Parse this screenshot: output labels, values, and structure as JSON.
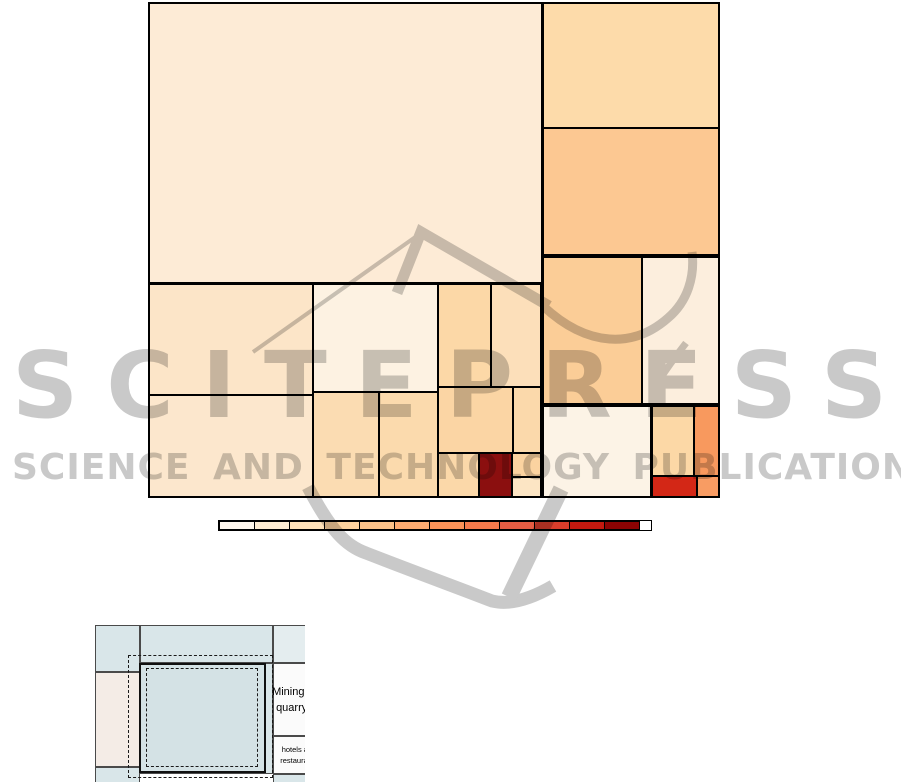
{
  "watermark": {
    "title": "SCITEPRESS",
    "subtitle": "SCIENCE AND TECHNOLOGY PUBLICATIONS",
    "color": "#c9c9c9"
  },
  "chart_data": [
    {
      "type": "treemap",
      "title": "",
      "description": "Unlabeled treemap of rectangles shaded by an OrRd (cream-to-dark-red) color scale",
      "bounds": {
        "x": 148,
        "y": 2,
        "w": 572,
        "h": 496
      },
      "cells": [
        {
          "x": 148,
          "y": 2,
          "w": 394,
          "h": 281,
          "c": "#fdebd6"
        },
        {
          "x": 542,
          "y": 2,
          "w": 178,
          "h": 126,
          "c": "#fddbaa"
        },
        {
          "x": 542,
          "y": 128,
          "w": 178,
          "h": 128,
          "c": "#fcc892"
        },
        {
          "x": 542,
          "y": 256,
          "w": 100,
          "h": 149,
          "c": "#fbcd97"
        },
        {
          "x": 642,
          "y": 256,
          "w": 78,
          "h": 149,
          "c": "#fceedd"
        },
        {
          "x": 542,
          "y": 405,
          "w": 109,
          "h": 93,
          "c": "#fcf3e6"
        },
        {
          "x": 651,
          "y": 405,
          "w": 43,
          "h": 71,
          "c": "#fcd8a6"
        },
        {
          "x": 694,
          "y": 405,
          "w": 26,
          "h": 71,
          "c": "#f8995e"
        },
        {
          "x": 651,
          "y": 476,
          "w": 46,
          "h": 22,
          "c": "#d32716"
        },
        {
          "x": 697,
          "y": 476,
          "w": 23,
          "h": 22,
          "c": "#f89c63"
        },
        {
          "x": 148,
          "y": 283,
          "w": 165,
          "h": 112,
          "c": "#fce5c8"
        },
        {
          "x": 148,
          "y": 395,
          "w": 165,
          "h": 103,
          "c": "#fce7cd"
        },
        {
          "x": 313,
          "y": 283,
          "w": 125,
          "h": 109,
          "c": "#fdf2e2"
        },
        {
          "x": 313,
          "y": 392,
          "w": 66,
          "h": 106,
          "c": "#fbdcb2"
        },
        {
          "x": 379,
          "y": 392,
          "w": 59,
          "h": 106,
          "c": "#fbdaad"
        },
        {
          "x": 438,
          "y": 283,
          "w": 53,
          "h": 104,
          "c": "#fcd8a7"
        },
        {
          "x": 491,
          "y": 283,
          "w": 51,
          "h": 104,
          "c": "#fcdfba"
        },
        {
          "x": 438,
          "y": 387,
          "w": 75,
          "h": 66,
          "c": "#fbd5a4"
        },
        {
          "x": 513,
          "y": 387,
          "w": 29,
          "h": 66,
          "c": "#fbd9ab"
        },
        {
          "x": 438,
          "y": 453,
          "w": 41,
          "h": 45,
          "c": "#fbd8a9"
        },
        {
          "x": 479,
          "y": 453,
          "w": 33,
          "h": 45,
          "c": "#8b0f0f"
        },
        {
          "x": 512,
          "y": 453,
          "w": 30,
          "h": 24,
          "c": "#fbd3a0"
        },
        {
          "x": 512,
          "y": 477,
          "w": 30,
          "h": 21,
          "c": "#fce5c4"
        }
      ],
      "group_outlines": [
        {
          "x": 148,
          "y": 2,
          "w": 572,
          "h": 496
        },
        {
          "x": 542,
          "y": 2,
          "w": 178,
          "h": 254
        },
        {
          "x": 148,
          "y": 283,
          "w": 394,
          "h": 215
        },
        {
          "x": 542,
          "y": 256,
          "w": 178,
          "h": 149
        },
        {
          "x": 542,
          "y": 405,
          "w": 178,
          "h": 93
        },
        {
          "x": 651,
          "y": 405,
          "w": 69,
          "h": 93
        }
      ],
      "legend": {
        "x": 218,
        "y": 520,
        "w": 432,
        "h": 9,
        "colors": [
          "#fff7ec",
          "#feecd2",
          "#fde0b8",
          "#fdd29e",
          "#fcc289",
          "#fcab71",
          "#fc9258",
          "#f57a4c",
          "#e65d43",
          "#d73d2b",
          "#c3190f",
          "#8c0303"
        ]
      }
    },
    {
      "type": "treemap",
      "title": "",
      "description": "Cropped zoom-in inset of a second treemap with dashed selection rectangles",
      "origin": {
        "x": 95,
        "y": 625,
        "w": 210,
        "h": 157
      },
      "cells": [
        {
          "x": 0,
          "y": 0,
          "w": 45,
          "h": 47,
          "c": "#d9e6e9"
        },
        {
          "x": 0,
          "y": 47,
          "w": 45,
          "h": 95,
          "c": "#f4ece6"
        },
        {
          "x": 0,
          "y": 142,
          "w": 45,
          "h": 16,
          "c": "#d9e6e9"
        },
        {
          "x": 45,
          "y": 0,
          "w": 133,
          "h": 38,
          "c": "#d9e6e9"
        },
        {
          "x": 178,
          "y": 0,
          "w": 40,
          "h": 38,
          "c": "#e4edef"
        },
        {
          "x": 45,
          "y": 38,
          "w": 133,
          "h": 111,
          "c": "#d9e6e9"
        },
        {
          "x": 178,
          "y": 38,
          "w": 40,
          "h": 73,
          "c": "#fbfbfb"
        },
        {
          "x": 178,
          "y": 111,
          "w": 40,
          "h": 38,
          "c": "#fbfbfb"
        },
        {
          "x": 178,
          "y": 149,
          "w": 40,
          "h": 10,
          "c": "#d9e6e9"
        }
      ],
      "square": {
        "x": 44,
        "y": 38,
        "w": 127,
        "h": 110,
        "c": "#d4e2e5"
      },
      "dashed_rects": [
        {
          "x": 33,
          "y": 30,
          "w": 145,
          "h": 123
        },
        {
          "x": 51,
          "y": 43,
          "w": 112,
          "h": 99
        }
      ],
      "labels": [
        {
          "text": "Mining and quarrying",
          "x": 176,
          "y": 40,
          "w": 56,
          "h": 70,
          "size": 11
        },
        {
          "text": "hotels and restaurants",
          "x": 176,
          "y": 113,
          "w": 56,
          "h": 34,
          "size": 7.5
        }
      ]
    }
  ]
}
